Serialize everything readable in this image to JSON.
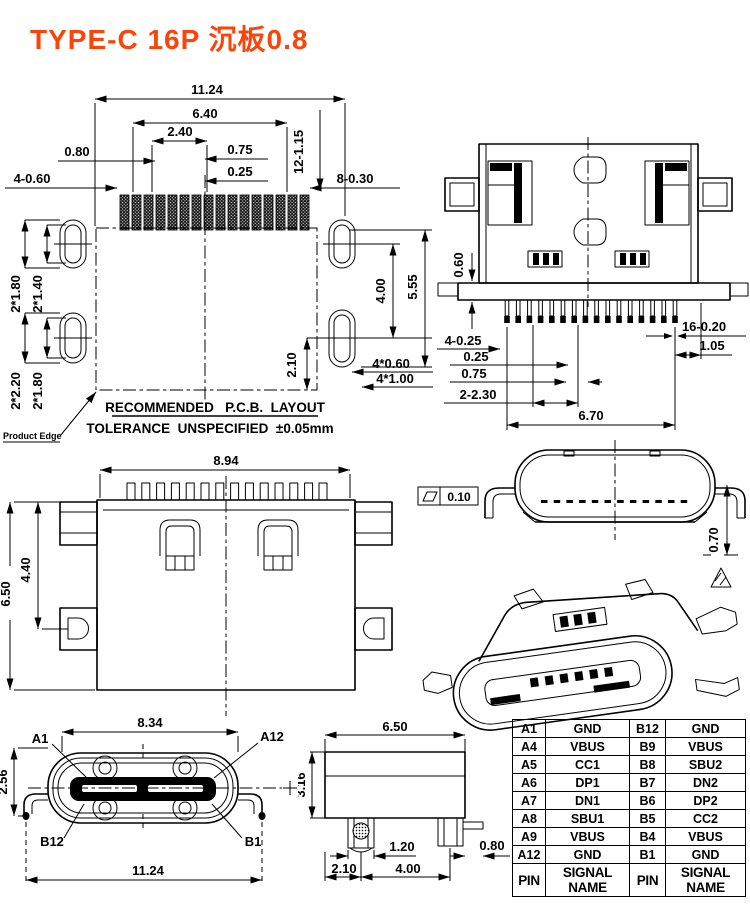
{
  "title": "TYPE-C 16P 沉板0.8",
  "colors": {
    "title": "#fc4408",
    "line": "#000000",
    "bg": "#ffffff"
  },
  "pcb_layout": {
    "w_overall": "11.24",
    "w_640": "6.40",
    "w_240": "2.40",
    "p_080": "0.80",
    "p_075": "0.75",
    "p_025": "0.25",
    "pads_len": "12-1.15",
    "pads_gnd": "4-0.60",
    "pads_sig": "8-0.30",
    "hole_180a": "2*1.80",
    "hole_140": "2*1.40",
    "hole_220": "2*2.20",
    "hole_180b": "2*1.80",
    "v_400": "4.00",
    "v_555": "5.55",
    "v_210": "2.10",
    "hole_060": "4*0.60",
    "hole_100": "4*1.00",
    "note1": "RECOMMENDED   P.C.B.  LAYOUT",
    "note2": "TOLERANCE  UNSPECIFIED  ±0.05mm",
    "product_edge": "Product Edge"
  },
  "bottom_view": {
    "t_060": "0.60",
    "p4_025": "4-0.25",
    "p_025": "0.25",
    "p_075": "0.75",
    "p2_230": "2-2.30",
    "w_670": "6.70",
    "p16_020": "16-0.20",
    "p_105": "1.05"
  },
  "top_view": {
    "w_894": "8.94",
    "h_440": "4.40",
    "h_650": "6.50"
  },
  "front_view": {
    "flatness": "0.10",
    "h_070": "0.70"
  },
  "mating_view": {
    "w_834": "8.34",
    "h_256": "2.56",
    "w_1124": "11.24",
    "pin_a1": "A1",
    "pin_a12": "A12",
    "pin_b12": "B12",
    "pin_b1": "B1"
  },
  "side_view": {
    "w_650": "6.50",
    "h_316": "3.16",
    "w_120": "1.20",
    "w_080": "0.80",
    "w_210": "2.10",
    "w_400": "4.00"
  },
  "pin_table": {
    "header_pin": "PIN",
    "header_signal": "SIGNAL NAME",
    "rows": [
      {
        "pa": "A1",
        "sa": "GND",
        "pb": "B12",
        "sb": "GND"
      },
      {
        "pa": "A4",
        "sa": "VBUS",
        "pb": "B9",
        "sb": "VBUS"
      },
      {
        "pa": "A5",
        "sa": "CC1",
        "pb": "B8",
        "sb": "SBU2"
      },
      {
        "pa": "A6",
        "sa": "DP1",
        "pb": "B7",
        "sb": "DN2"
      },
      {
        "pa": "A7",
        "sa": "DN1",
        "pb": "B6",
        "sb": "DP2"
      },
      {
        "pa": "A8",
        "sa": "SBU1",
        "pb": "B5",
        "sb": "CC2"
      },
      {
        "pa": "A9",
        "sa": "VBUS",
        "pb": "B4",
        "sb": "VBUS"
      },
      {
        "pa": "A12",
        "sa": "GND",
        "pb": "B1",
        "sb": "GND"
      }
    ]
  }
}
